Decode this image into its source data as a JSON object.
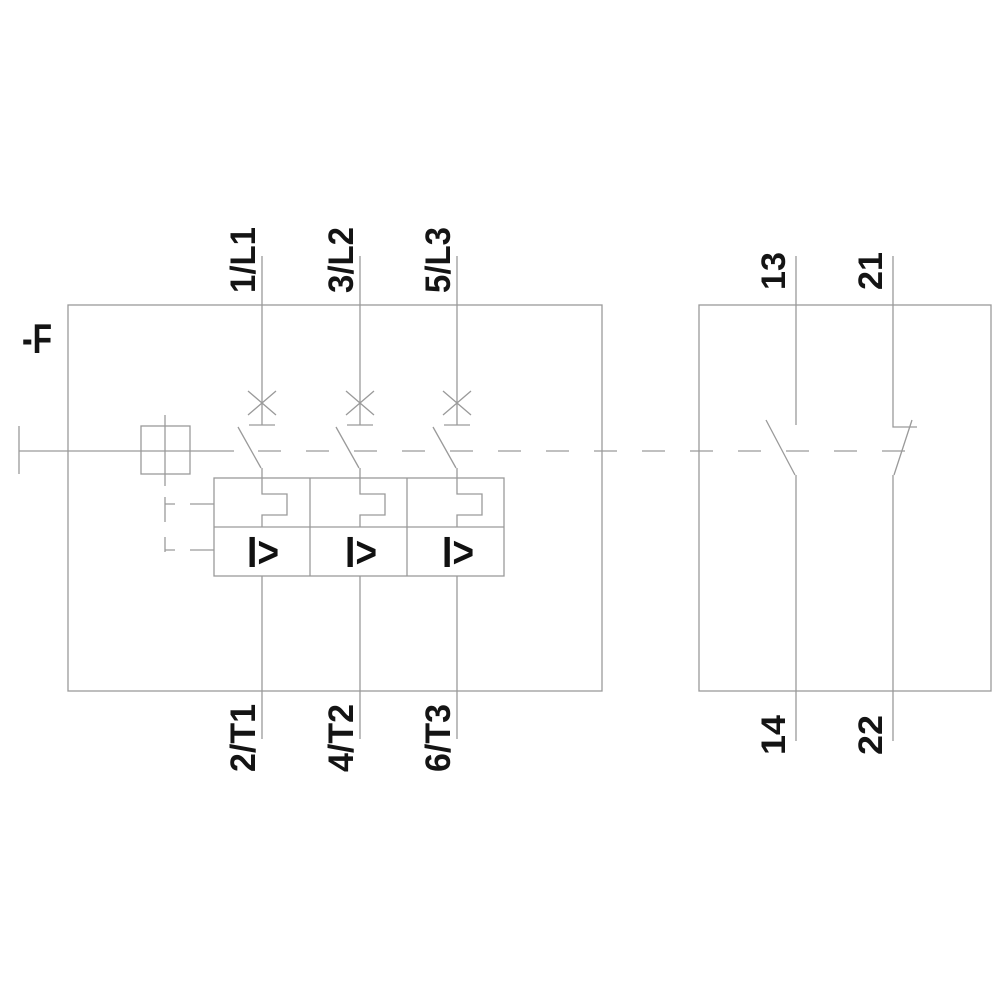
{
  "schematic": {
    "device_designation": "-F",
    "left_block": {
      "top_terminals": [
        "1/L1",
        "3/L2",
        "5/L3"
      ],
      "bottom_terminals": [
        "2/T1",
        "4/T2",
        "6/T3"
      ],
      "overcurrent_trip_symbol": "I>"
    },
    "right_block": {
      "no_contact": {
        "top_terminal": "13",
        "bottom_terminal": "14"
      },
      "nc_contact": {
        "top_terminal": "21",
        "bottom_terminal": "22"
      }
    },
    "colors": {
      "line": "#9a9a9a",
      "label_text": "#141414",
      "background": "#ffffff"
    }
  }
}
